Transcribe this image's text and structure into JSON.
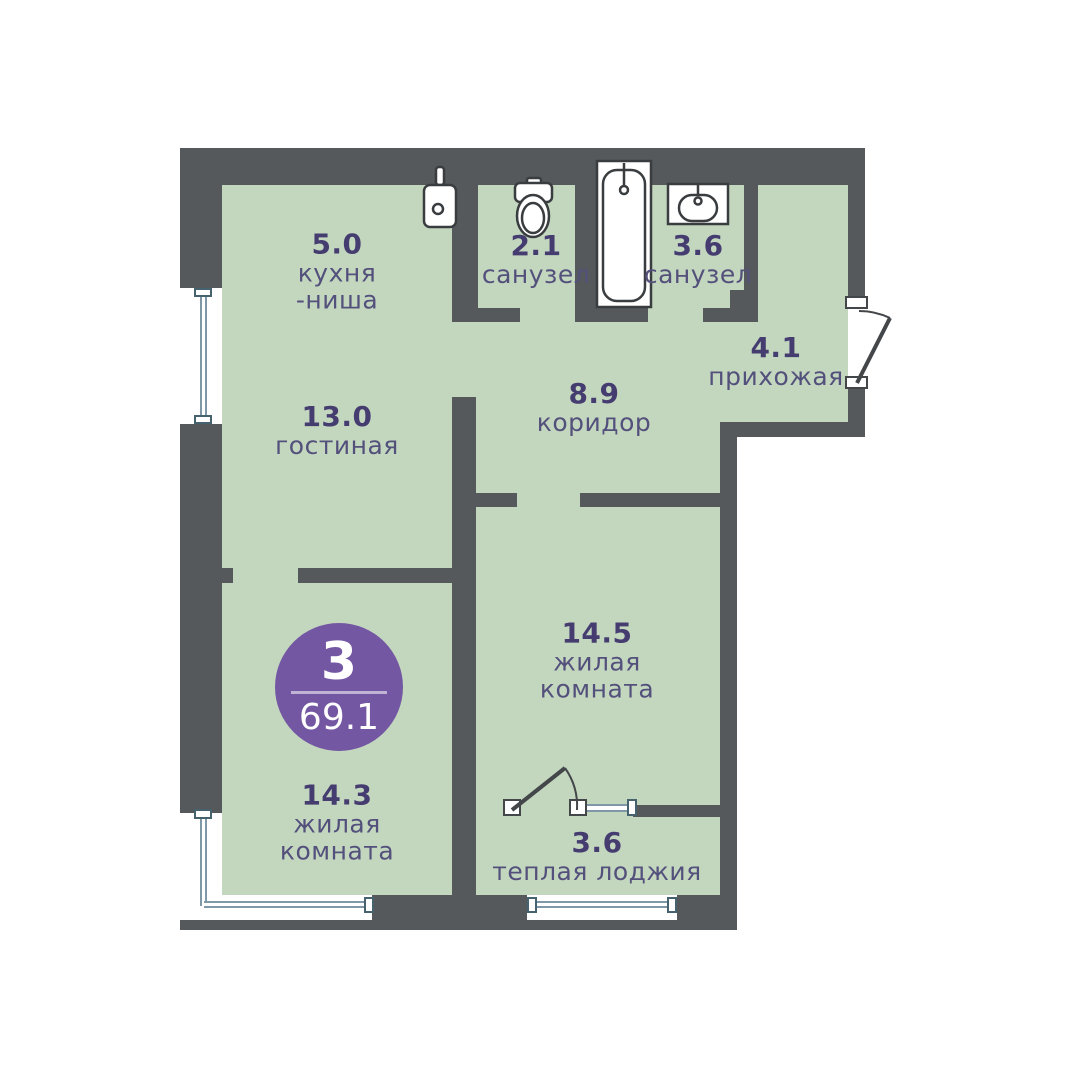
{
  "plan": {
    "badge": {
      "rooms_count": "3",
      "total_area": "69.1"
    },
    "rooms": [
      {
        "key": "kitchen",
        "area": "5.0",
        "lines": [
          "кухня",
          "-ниша"
        ]
      },
      {
        "key": "living",
        "area": "13.0",
        "lines": [
          "гостиная"
        ]
      },
      {
        "key": "bath1",
        "area": "2.1",
        "lines": [
          "санузел"
        ]
      },
      {
        "key": "bath2",
        "area": "3.6",
        "lines": [
          "санузел"
        ]
      },
      {
        "key": "hallway",
        "area": "4.1",
        "lines": [
          "прихожая"
        ]
      },
      {
        "key": "corridor",
        "area": "8.9",
        "lines": [
          "коридор"
        ]
      },
      {
        "key": "bedroom1",
        "area": "14.5",
        "lines": [
          "жилая",
          "комната"
        ]
      },
      {
        "key": "bedroom2",
        "area": "14.3",
        "lines": [
          "жилая",
          "комната"
        ]
      },
      {
        "key": "loggia",
        "area": "3.6",
        "lines": [
          "теплая лоджия"
        ]
      }
    ],
    "icons": [
      "kitchen-sink-icon",
      "toilet-icon",
      "washbasin-icon",
      "bathtub-icon",
      "entry-door-swing-icon",
      "loggia-door-swing-icon"
    ],
    "colors": {
      "wall": "#56595B",
      "floor": "#C3D7BF",
      "area_number": "#453C70",
      "room_name": "#54507C",
      "badge": "#7457A2",
      "window": "#7E98A8"
    }
  }
}
